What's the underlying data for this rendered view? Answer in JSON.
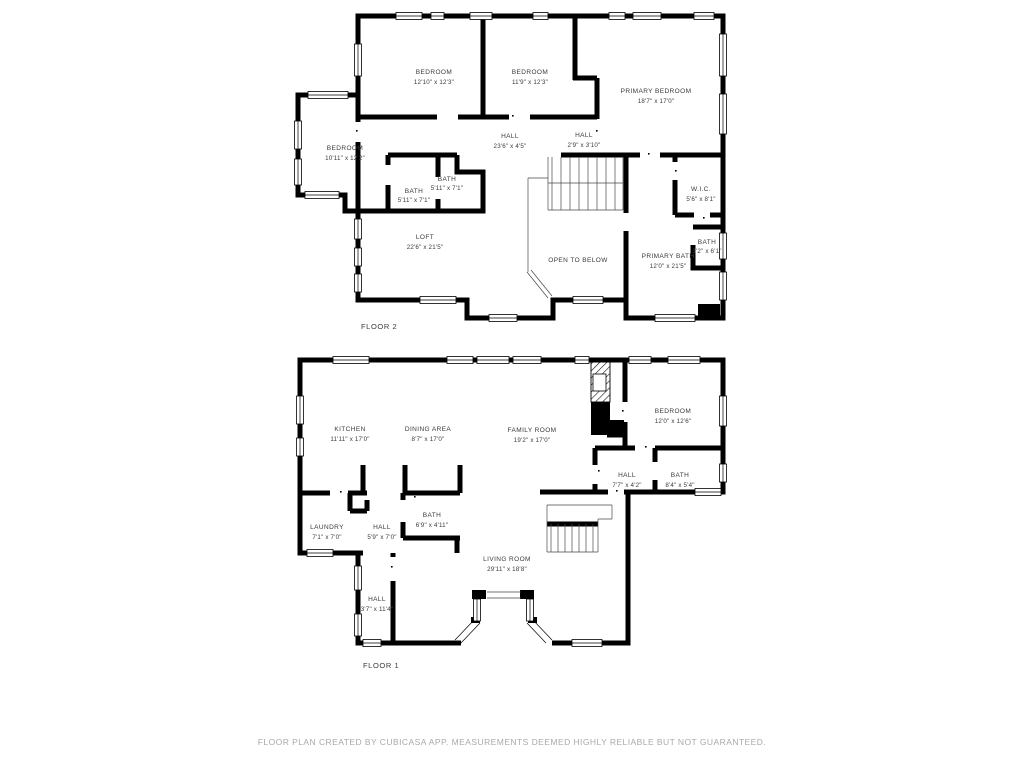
{
  "colors": {
    "wall": "#000000",
    "label": "#3a3a3a",
    "footer_text": "#a9a9a9",
    "background": "#ffffff"
  },
  "floor2": {
    "title": "FLOOR 2",
    "rooms": {
      "bedroom_a": {
        "name": "BEDROOM",
        "dims": "12'10\" x 12'3\""
      },
      "bedroom_b": {
        "name": "BEDROOM",
        "dims": "11'9\" x 12'3\""
      },
      "primary_bedroom": {
        "name": "PRIMARY BEDROOM",
        "dims": "18'7\" x 17'0\""
      },
      "bedroom_c": {
        "name": "BEDROOM",
        "dims": "10'11\" x 12'2\""
      },
      "hall": {
        "name": "HALL",
        "dims": "23'6\" x 4'5\""
      },
      "hall_small": {
        "name": "HALL",
        "dims": "2'9\" x 3'10\""
      },
      "bath_a": {
        "name": "BATH",
        "dims": "5'11\" x 7'1\""
      },
      "bath_b": {
        "name": "BATH",
        "dims": "5'11\" x 7'1\""
      },
      "wic": {
        "name": "W.I.C.",
        "dims": "5'6\" x 8'1\""
      },
      "loft": {
        "name": "LOFT",
        "dims": "22'6\" x 21'5\""
      },
      "open_to_below": {
        "name": "OPEN TO BELOW"
      },
      "primary_bath": {
        "name": "PRIMARY BATH",
        "dims": "12'0\" x 21'5\""
      },
      "bath_c": {
        "name": "BATH",
        "dims": "3'2\" x 6'1\""
      }
    }
  },
  "floor1": {
    "title": "FLOOR 1",
    "rooms": {
      "kitchen": {
        "name": "KITCHEN",
        "dims": "11'11\" x 17'0\""
      },
      "dining_area": {
        "name": "DINING AREA",
        "dims": "8'7\" x 17'0\""
      },
      "family_room": {
        "name": "FAMILY ROOM",
        "dims": "19'2\" x 17'0\""
      },
      "bedroom": {
        "name": "BEDROOM",
        "dims": "12'0\" x 12'6\""
      },
      "hall_upper": {
        "name": "HALL",
        "dims": "7'7\" x 4'2\""
      },
      "bath_upper": {
        "name": "BATH",
        "dims": "8'4\" x 5'4\""
      },
      "laundry": {
        "name": "LAUNDRY",
        "dims": "7'1\" x 7'0\""
      },
      "hall_mid": {
        "name": "HALL",
        "dims": "5'9\" x 7'0\""
      },
      "bath_mid": {
        "name": "BATH",
        "dims": "6'9\" x 4'11\""
      },
      "living_room": {
        "name": "LIVING ROOM",
        "dims": "29'11\" x 18'8\""
      },
      "hall_lower": {
        "name": "HALL",
        "dims": "3'7\" x 11'4\""
      }
    }
  },
  "footer": {
    "text": "FLOOR PLAN CREATED BY CUBICASA APP. MEASUREMENTS DEEMED HIGHLY RELIABLE BUT NOT GUARANTEED."
  }
}
